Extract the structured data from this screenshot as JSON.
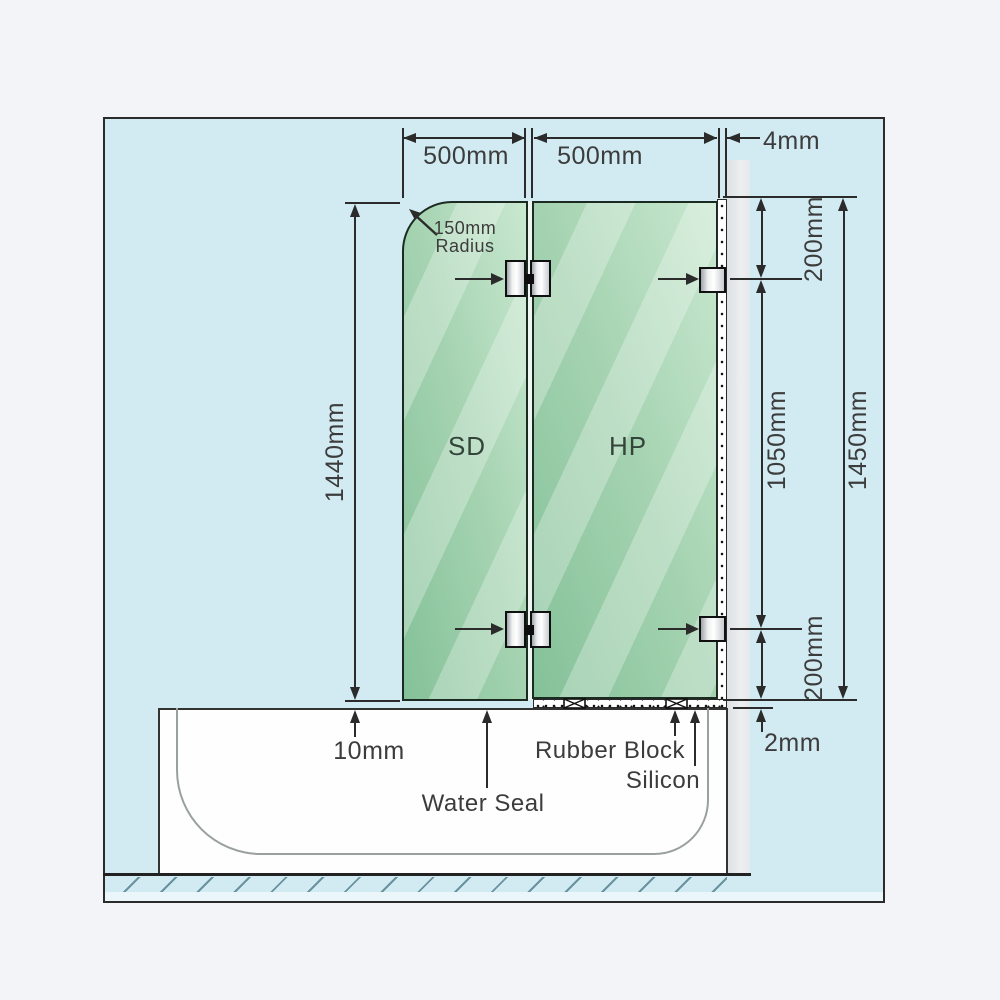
{
  "dimensions": {
    "sd_width": "500mm",
    "hp_width": "500mm",
    "wall_silicon_gap": "4mm",
    "sd_height": "1440mm",
    "corner_radius_line1": "150mm",
    "corner_radius_line2": "Radius",
    "top_bracket_offset": "200mm",
    "bracket_spacing": "1050mm",
    "hp_height": "1450mm",
    "bottom_bracket_offset": "200mm",
    "base_silicon_gap": "2mm",
    "glass_tub_gap": "10mm"
  },
  "panels": {
    "sd": "SD",
    "hp": "HP"
  },
  "annotations": {
    "water_seal": "Water Seal",
    "rubber_block": "Rubber Block",
    "silicon": "Silicon"
  },
  "colors": {
    "background_blue": "#d2ebf3",
    "glass_green": "#a5d3b1",
    "wall_gray": "#e6e9eb",
    "line_dark": "#2b2b2b",
    "hatch_blue": "#69929f"
  }
}
